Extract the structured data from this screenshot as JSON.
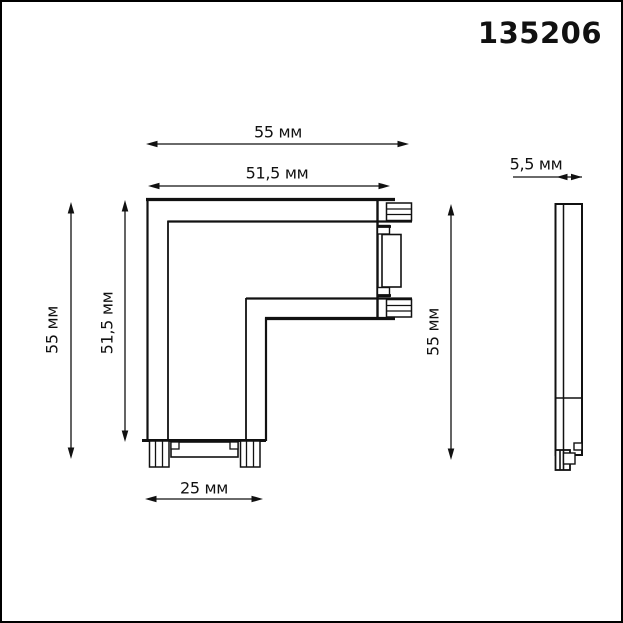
{
  "product_code": "135206",
  "drawing": {
    "front_view": {
      "dim_width_outer": "55 мм",
      "dim_width_inner": "51,5 мм",
      "dim_height_left": "55 мм",
      "dim_height_inner": "51,5 мм",
      "dim_height_right": "55 мм",
      "dim_bottom_width": "25 мм"
    },
    "side_view": {
      "dim_thickness": "5,5 мм"
    }
  },
  "units": "мм",
  "colors": {
    "line": "#111111",
    "background": "#ffffff",
    "frame": "#000000"
  }
}
